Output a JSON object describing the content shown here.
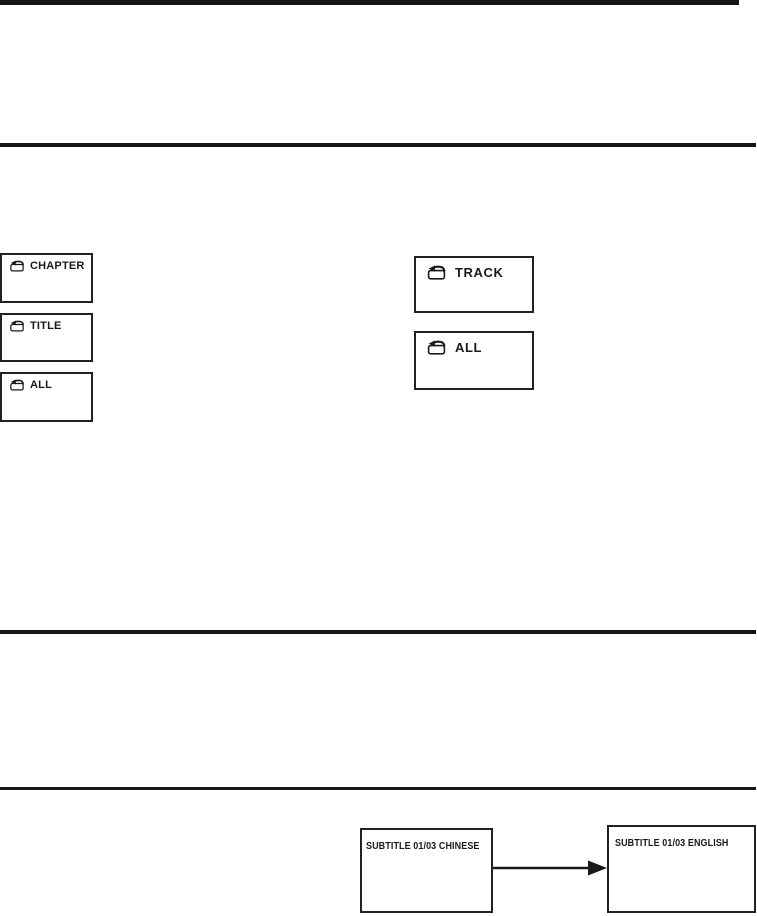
{
  "colors": {
    "ink": "#1a1a1a",
    "background": "#ffffff"
  },
  "icons": {
    "repeat_folder": "repeat-folder-icon",
    "flow_arrow": "right-arrow-icon"
  },
  "repeat_display": {
    "dvd": [
      {
        "label": "CHAPTER"
      },
      {
        "label": "TITLE"
      },
      {
        "label": "ALL"
      }
    ],
    "cd": [
      {
        "label": "TRACK"
      },
      {
        "label": "ALL"
      }
    ]
  },
  "subtitle_display": {
    "before": "SUBTITLE 01/03 CHINESE",
    "after": "SUBTITLE 01/03 ENGLISH"
  }
}
